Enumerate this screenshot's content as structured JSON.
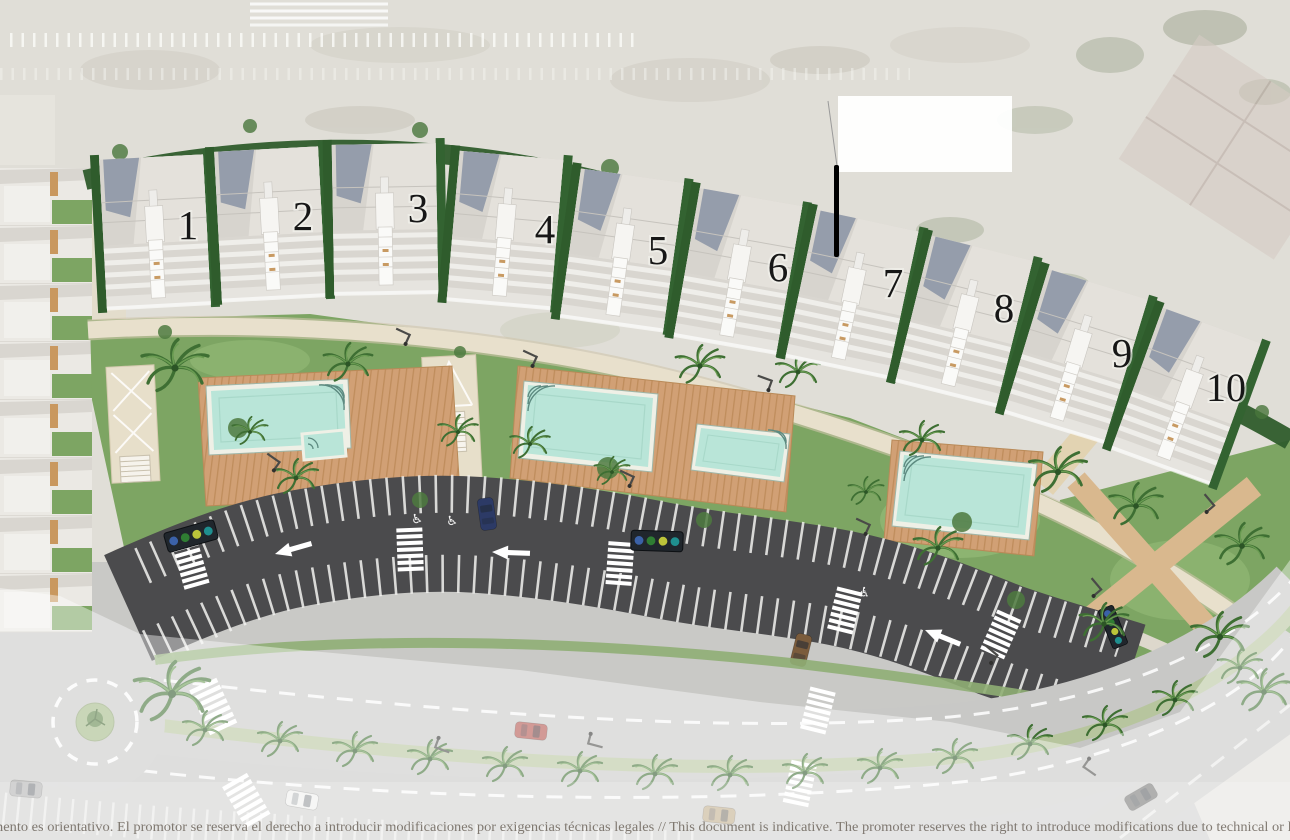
{
  "site_plan": {
    "units": [
      {
        "label": "1"
      },
      {
        "label": "2"
      },
      {
        "label": "3"
      },
      {
        "label": "4"
      },
      {
        "label": "5"
      },
      {
        "label": "6"
      },
      {
        "label": "7"
      },
      {
        "label": "8"
      },
      {
        "label": "9"
      },
      {
        "label": "10"
      }
    ],
    "pool_count": 4,
    "roundabout_count": 1,
    "parking": {
      "arrow_direction": "left",
      "rows": 2
    },
    "colors": {
      "sand": "#e0ded7",
      "lawn": "#7da563",
      "lawn_light": "#94bb78",
      "hedge": "#2f5c2c",
      "deck_wood": "#d1a075",
      "pool_water": "#b9e5d8",
      "pool_rim": "#eff0e6",
      "path": "#e7dfca",
      "asphalt": "#4b4b4d",
      "road": "#c8c8c6",
      "median_green": "#b7c59e",
      "marking_white": "#ffffff"
    },
    "disclaimer_text": "mento es orientativo. El promotor se reserva el derecho a introducir modificaciones por exigencias técnicas legales // This document is indicative. The promoter reserves the right to introduce modifications due to technical or le"
  }
}
